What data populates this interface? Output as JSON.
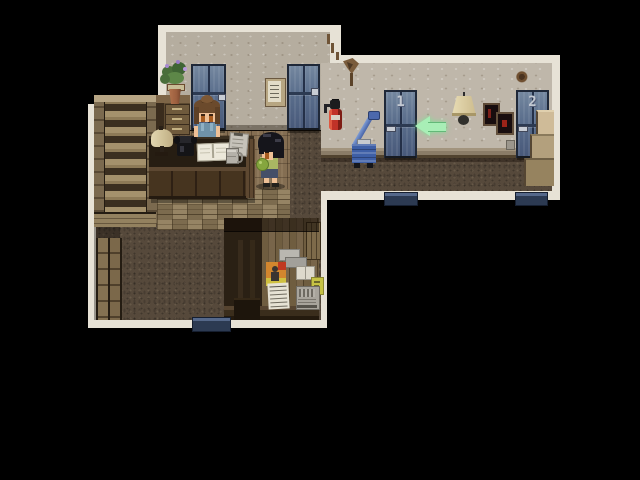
{
  "scene": {
    "genre": "top-down pixel RPG interior",
    "rooms": [
      "reception lobby",
      "guest room hallway"
    ],
    "background_color": "#000000"
  },
  "hallway": {
    "doors": [
      {
        "number": "1",
        "side": "north"
      },
      {
        "number": "2",
        "side": "north"
      }
    ],
    "quest_arrow": {
      "direction": "left",
      "target": "door-1",
      "color": "#a8eeb6"
    },
    "objects": [
      "fire-extinguisher",
      "blue-hand-cart",
      "hanging-lamp",
      "dark-picture-frame-1",
      "dark-picture-frame-2",
      "wall-stain",
      "wall-outlet",
      "beige-staircase-up",
      "doormat-1",
      "doormat-2",
      "wall-crack"
    ]
  },
  "lobby": {
    "doors": [
      {
        "side": "north-left"
      },
      {
        "side": "north-right"
      }
    ],
    "reception_desk": {
      "items": [
        "desk-lamp",
        "telephone",
        "open-ledger",
        "note-stand",
        "metal-cup"
      ]
    },
    "decor": [
      "potted-plant-purple-flowers",
      "drawer-cabinet",
      "certificate-frame",
      "wooden-staircase-up",
      "understair-posts",
      "south-doormat"
    ],
    "poster_wall": {
      "items": [
        "gray-plaque",
        "gray-plaque-2",
        "orange-poster-figure",
        "white-cards",
        "paper-list",
        "yellow-poster",
        "radiator-vent",
        "dark-crate"
      ]
    }
  },
  "characters": [
    {
      "id": "receptionist",
      "hair": "brown with bun",
      "outfit": "blue tank top",
      "position": "behind reception desk"
    },
    {
      "id": "boy",
      "hair": "black",
      "outfit": "green shirt, blue shorts",
      "holding": "green apple",
      "position": "in front of desk"
    }
  ],
  "palette": {
    "border_cream": "#e7e2d6",
    "wall_gray": "#b5ad9f",
    "carpet_brown": "#56493b",
    "door_blue": "#5a6e8c",
    "arrow_green": "#a8eeb6",
    "mat_navy": "#2c3a52",
    "extinguisher_red": "#c03228",
    "cart_blue": "#3e5fa6"
  }
}
